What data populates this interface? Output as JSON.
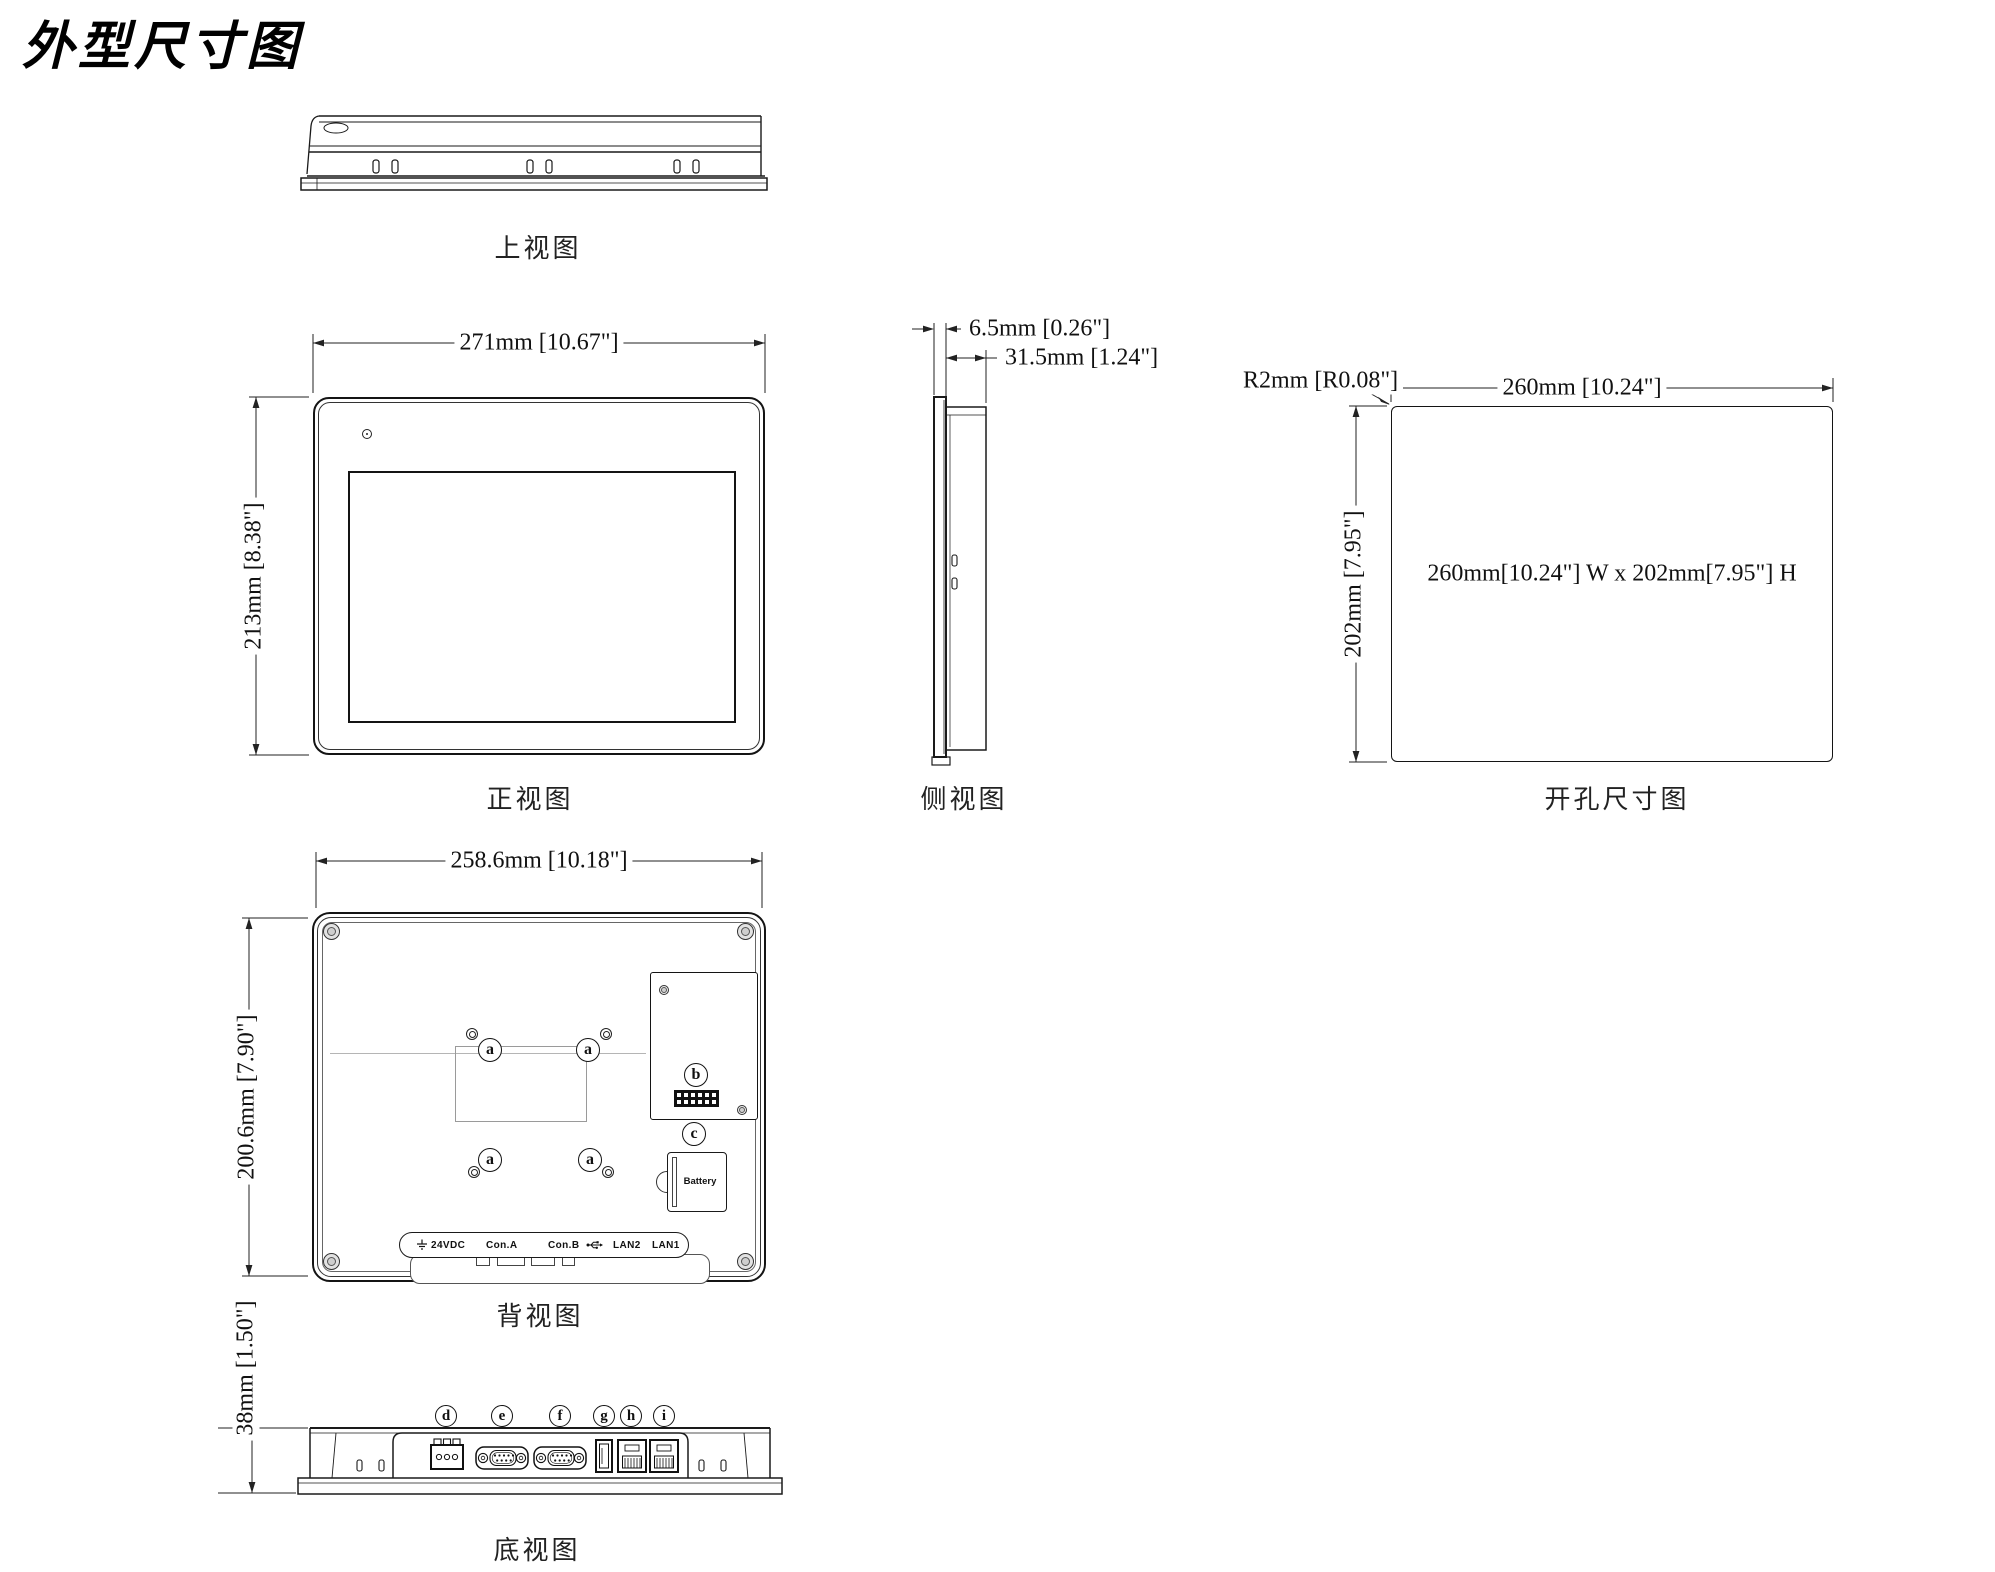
{
  "title": "外型尺寸图",
  "views": {
    "top": {
      "label": "上视图"
    },
    "front": {
      "label": "正视图",
      "width_dim": "271mm [10.67\"]",
      "height_dim": "213mm [8.38\"]"
    },
    "side": {
      "label": "侧视图",
      "bezel_dim": "6.5mm [0.26\"]",
      "depth_dim": "31.5mm [1.24\"]"
    },
    "cutout": {
      "label": "开孔尺寸图",
      "width_dim": "260mm [10.24\"]",
      "height_dim": "202mm [7.95\"]",
      "radius_dim": "R2mm [R0.08\"]",
      "center_note": "260mm[10.24\"]  W x 202mm[7.95\"] H"
    },
    "back": {
      "label": "背视图",
      "width_dim": "258.6mm [10.18\"]",
      "height_dim": "200.6mm [7.90\"]",
      "callout_a": "a",
      "callout_b": "b",
      "callout_c": "c",
      "battery_label": "Battery",
      "ports": {
        "power": "24VDC",
        "con_a": "Con.A",
        "con_b": "Con.B",
        "lan2": "LAN2",
        "lan1": "LAN1"
      }
    },
    "bottom": {
      "label": "底视图",
      "height_dim": "38mm [1.50\"]",
      "callouts": [
        "d",
        "e",
        "f",
        "g",
        "h",
        "i"
      ]
    }
  }
}
